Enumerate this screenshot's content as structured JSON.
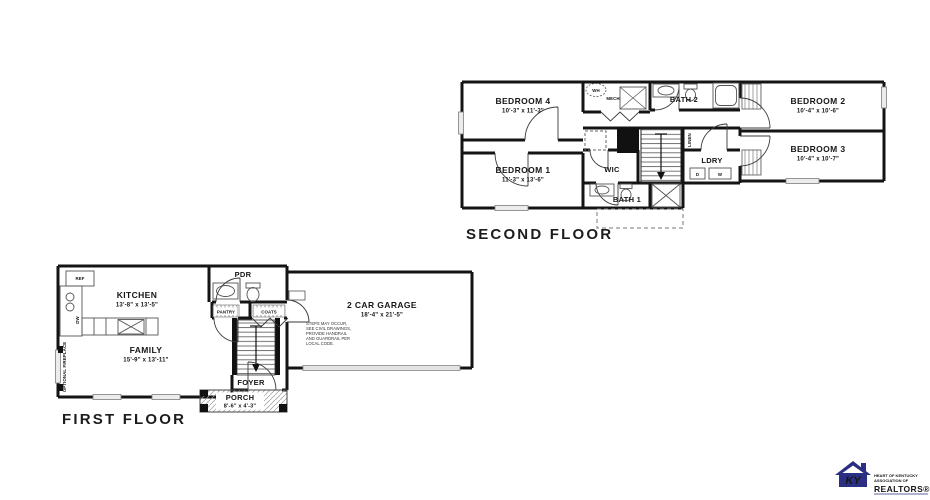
{
  "second_floor": {
    "title": "SECOND FLOOR",
    "rooms": {
      "bedroom4": {
        "name": "BEDROOM 4",
        "dims": "10'-3\" x 11'-3\""
      },
      "bedroom1": {
        "name": "BEDROOM 1",
        "dims": "11'-3\" x 13'-6\""
      },
      "bedroom2": {
        "name": "BEDROOM 2",
        "dims": "10'-4\" x 10'-6\""
      },
      "bedroom3": {
        "name": "BEDROOM 3",
        "dims": "10'-4\" x 10'-7\""
      },
      "bath1": {
        "name": "BATH 1"
      },
      "bath2": {
        "name": "BATH 2"
      },
      "wic": {
        "name": "WIC"
      },
      "ldry": {
        "name": "LDRY"
      },
      "linen": {
        "name": "LINEN"
      },
      "wh": {
        "name": "WH"
      },
      "mech": {
        "name": "MECH"
      },
      "dryer": "D",
      "washer": "W"
    }
  },
  "first_floor": {
    "title": "FIRST FLOOR",
    "rooms": {
      "kitchen": {
        "name": "KITCHEN",
        "dims": "13'-8\" x 13'-5\""
      },
      "family": {
        "name": "FAMILY",
        "dims": "15'-9\" x 13'-11\""
      },
      "garage": {
        "name": "2 CAR GARAGE",
        "dims": "18'-4\" x 21'-5\""
      },
      "garage_note": [
        "STEPS MAY OCCUR,",
        "SEE CIVIL DRAWINGS,",
        "PROVIDE HANDRAIL",
        "AND GUARDRAIL PER",
        "LOCAL CODE."
      ],
      "pdr": {
        "name": "PDR"
      },
      "pantry": {
        "name": "PANTRY"
      },
      "coats": {
        "name": "COATS"
      },
      "foyer": {
        "name": "FOYER"
      },
      "porch": {
        "name": "PORCH",
        "dims": "8'-6\" x 4'-3\""
      },
      "ref": "REF",
      "dw": "DW",
      "fireplace_note": "OPTIONAL FIREPLACE"
    }
  },
  "logo": {
    "monogram": "KY",
    "line1": "HEART OF KENTUCKY",
    "line2": "ASSOCIATION OF",
    "realtors": "REALTORS®",
    "color": "#2b2f84"
  }
}
